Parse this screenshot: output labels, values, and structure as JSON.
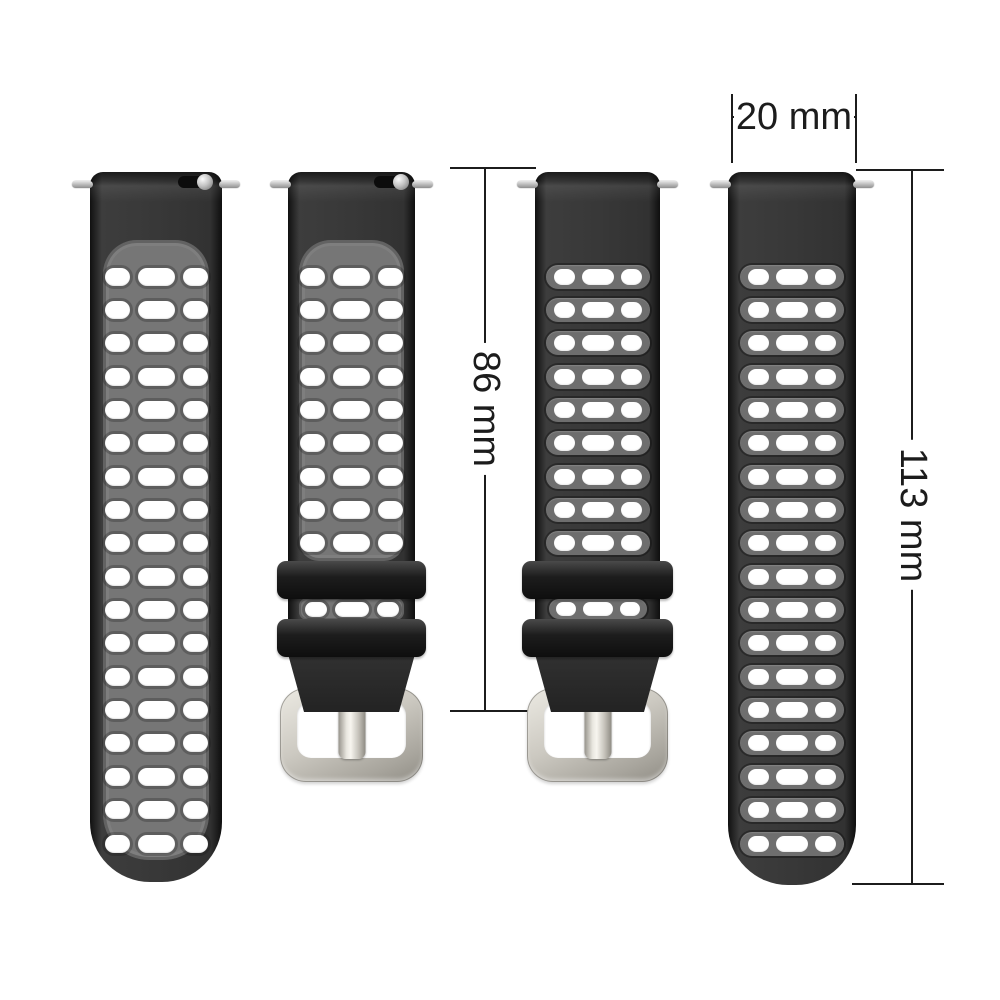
{
  "annotations": {
    "lug_width": {
      "label": "20 mm"
    },
    "buckle_side_length": {
      "label": "86 mm"
    },
    "long_side_length": {
      "label": "113 mm"
    }
  },
  "straps": [
    {
      "name": "long-strap-gray",
      "colorway": "gray",
      "part": "long",
      "hole_rows": 18,
      "holes_per_row": 3,
      "keeper_loop_rows": 0,
      "spring_bar_pins": 2,
      "quick_release_knob": true,
      "keeper_loops": 0,
      "buckle": false
    },
    {
      "name": "buckle-strap-gray",
      "colorway": "gray",
      "part": "buckle",
      "hole_rows": 9,
      "holes_per_row": 3,
      "keeper_loop_rows": 1,
      "spring_bar_pins": 2,
      "quick_release_knob": true,
      "keeper_loops": 2,
      "buckle": true
    },
    {
      "name": "buckle-strap-black",
      "colorway": "black",
      "part": "buckle",
      "hole_rows": 9,
      "holes_per_row": 3,
      "keeper_loop_rows": 1,
      "spring_bar_pins": 2,
      "quick_release_knob": false,
      "keeper_loops": 2,
      "buckle": true
    },
    {
      "name": "long-strap-black",
      "colorway": "black",
      "part": "long",
      "hole_rows": 18,
      "holes_per_row": 3,
      "keeper_loop_rows": 0,
      "spring_bar_pins": 2,
      "quick_release_knob": false,
      "keeper_loops": 0,
      "buckle": false
    }
  ],
  "colors": {
    "background": "#ffffff",
    "strap_black": "#323232",
    "panel_gray": "#767676",
    "groove_gray": "#6e6e6e",
    "hole_white": "#ffffff",
    "keeper_black": "#1d1d1d",
    "buckle_silver_light": "#eceae3",
    "buckle_silver": "#ccc9c1",
    "buckle_silver_dark": "#908d85",
    "pin_silver": "#8f8f8f",
    "annotation": "#1c1c1c"
  }
}
